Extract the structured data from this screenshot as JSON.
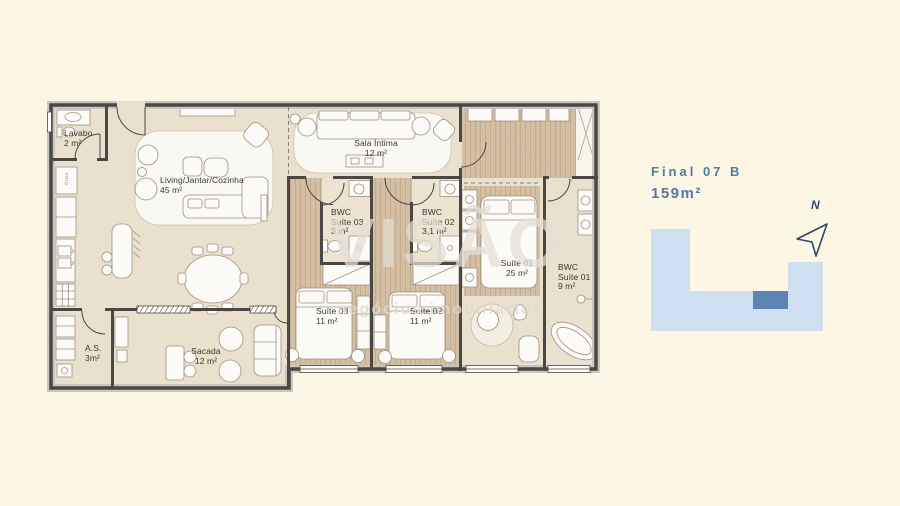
{
  "watermark": {
    "line1": "VISÃO",
    "line2": "negócios imobiliários"
  },
  "plan": {
    "rooms": [
      {
        "id": "lavabo",
        "line1": "Lavabo",
        "area": "2 m²"
      },
      {
        "id": "living",
        "line1": "Living/Jantar/Cozinha",
        "area": "45 m²"
      },
      {
        "id": "sala-intima",
        "line1": "Sala Íntima",
        "area": "12 m²"
      },
      {
        "id": "bwc-suite-03",
        "line1": "BWC",
        "line2": "Suíte 03",
        "area": "3 m²"
      },
      {
        "id": "bwc-suite-02",
        "line1": "BWC",
        "line2": "Suíte 02",
        "area": "3,1 m²"
      },
      {
        "id": "suite-01",
        "line1": "Suíte 01",
        "area": "25 m²"
      },
      {
        "id": "bwc-suite-01",
        "line1": "BWC",
        "line2": "Suíte 01",
        "area": "9 m²"
      },
      {
        "id": "suite-03",
        "line1": "Suíte 03",
        "area": "11 m²"
      },
      {
        "id": "suite-02",
        "line1": "Suíte 02",
        "area": "11 m²"
      },
      {
        "id": "as",
        "line1": "A.S.",
        "area": "3m²"
      },
      {
        "id": "sacada",
        "line1": "Sacada",
        "area": "12 m²"
      }
    ],
    "fridge_label": "FRIG"
  },
  "info": {
    "title": "Final 07 B",
    "area": "159m²",
    "compass_label": "N"
  },
  "colors": {
    "background": "#fcf6e4",
    "accent_blue": "#5479a2",
    "diagram_light_blue": "#cfdff2",
    "diagram_dark_blue": "#5d83b4",
    "floor_beige": "#e9e0cd",
    "floor_wood": "#d4bfa5",
    "wall": "#4b4742"
  }
}
